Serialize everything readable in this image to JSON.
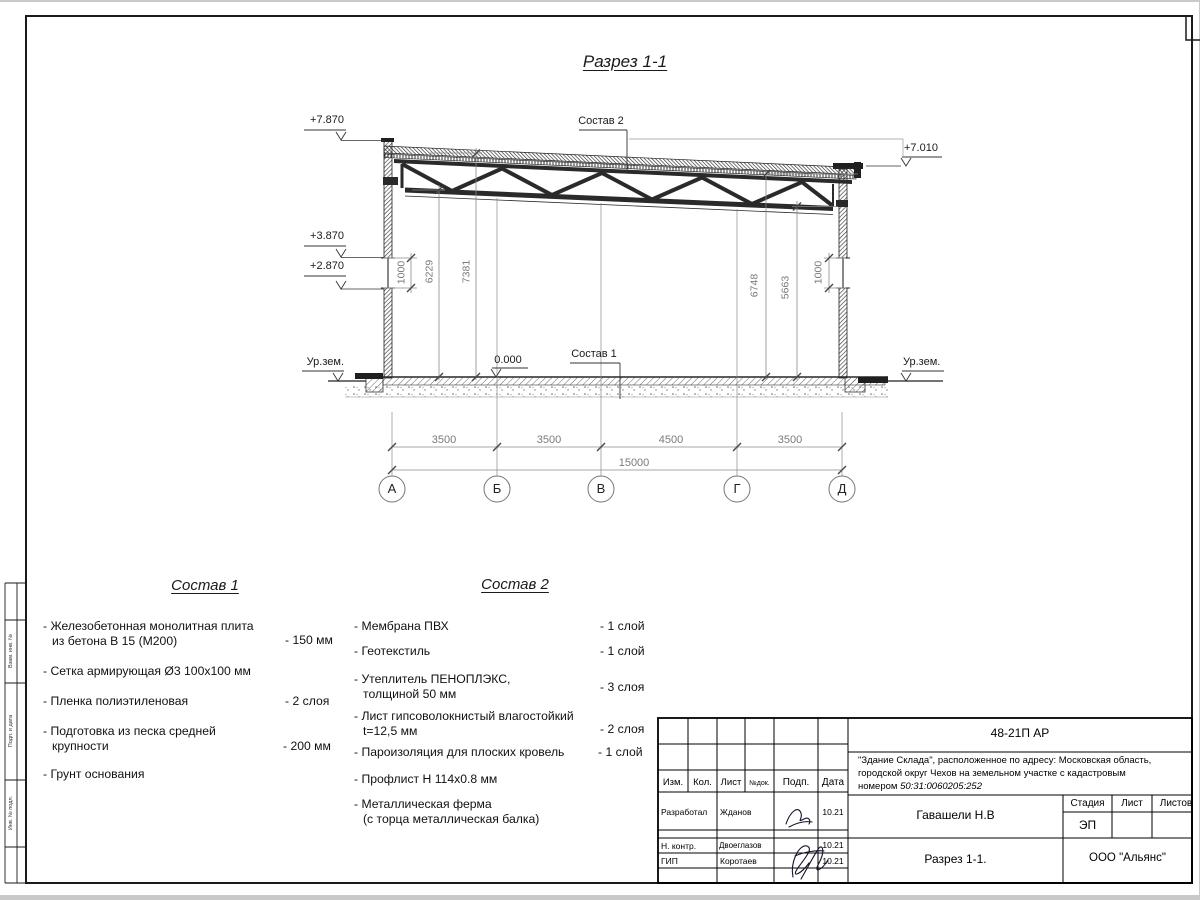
{
  "sheet": {
    "title": "Разрез 1-1"
  },
  "section": {
    "refs": {
      "sostav1": "Состав 1",
      "sostav2": "Состав 2"
    },
    "elevations": {
      "parapet": "+7.870",
      "roof_right": "+7.010",
      "window_top": "+3.870",
      "window_bottom": "+2.870",
      "zero": "0.000",
      "ground_left": "Ур.зем.",
      "ground_right": "Ур.зем."
    },
    "dims_left": [
      "1000",
      "6229",
      "7381"
    ],
    "dims_right": [
      "6748",
      "5663",
      "1000"
    ],
    "dims_bottom": [
      "3500",
      "3500",
      "4500",
      "3500"
    ],
    "dim_total": "15000",
    "axes": [
      "А",
      "Б",
      "В",
      "Г",
      "Д"
    ]
  },
  "sostav1": {
    "title": "Состав 1",
    "items": [
      {
        "name": "- Железобетонная  монолитная плита\nиз бетона В 15 (М200)",
        "value": "- 150 мм"
      },
      {
        "name": "- Сетка армирующая Ø3 100х100 мм",
        "value": ""
      },
      {
        "name": "- Пленка полиэтиленовая",
        "value": "-  2 слоя"
      },
      {
        "name": "- Подготовка из песка средней\nкрупности",
        "value": "- 200 мм"
      },
      {
        "name": "- Грунт основания",
        "value": ""
      }
    ]
  },
  "sostav2": {
    "title": "Состав 2",
    "items": [
      {
        "name": "- Мембрана ПВХ",
        "value": "- 1 слой"
      },
      {
        "name": "- Геотекстиль",
        "value": "- 1 слой"
      },
      {
        "name": "- Утеплитель ПЕНОПЛЭКС,\nтолщиной 50 мм",
        "value": "- 3 слоя"
      },
      {
        "name": "- Лист гипсоволокнистый влагостойкий\nt=12,5 мм",
        "value": "- 2 слоя"
      },
      {
        "name": "- Пароизоляция для плоских кровель",
        "value": "- 1 слой"
      },
      {
        "name": "- Профлист Н 114х0.8 мм",
        "value": ""
      },
      {
        "name": "- Металлическая ферма\n(с торца металлическая балка)",
        "value": ""
      }
    ]
  },
  "titleblock": {
    "doc_code": "48-21П АР",
    "project_text": "\"Здание Склада\", расположенное по адресу: Московская область,\nгородской округ Чехов на земельном участке с кадастровым\nномером ",
    "cadastral_number": "50:31:0060205:252",
    "col_headers": [
      "Изм.",
      "Кол.",
      "Лист",
      "№док.",
      "Подп.",
      "Дата"
    ],
    "rows": [
      {
        "role": "Разработал",
        "name": "Жданов",
        "date": "10.21"
      },
      {
        "role": "Н. контр.",
        "name": "Двоеглазов",
        "date": "10.21"
      },
      {
        "role": "ГИП",
        "name": "Коротаев",
        "date": "10.21"
      }
    ],
    "chief": "Гавашели Н.В",
    "stage_header": "Стадия",
    "sheet_header": "Лист",
    "sheets_header": "Листов",
    "stage_value": "ЭП",
    "drawing_name": "Разрез 1-1.",
    "company": "ООО \"Альянс\""
  },
  "frame": {
    "side_labels": [
      "Взам. инв. №",
      "Подп. и дата",
      "Инв. № подл."
    ]
  }
}
